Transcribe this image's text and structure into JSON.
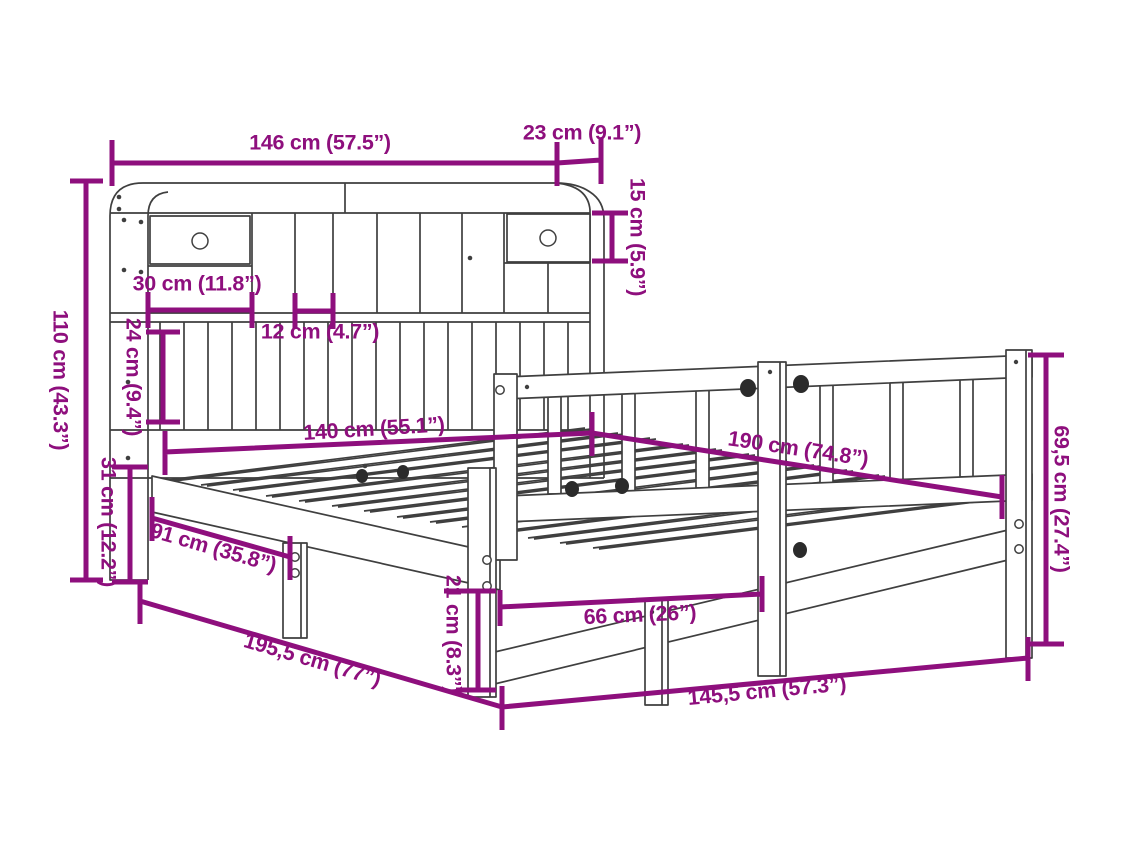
{
  "colors": {
    "accent": "#8E0F7D",
    "ink": "#3F3F3F",
    "background": "#FFFFFF"
  },
  "dims": {
    "headboard_width": "146 cm (57.5”)",
    "shelf_depth": "23 cm (9.1”)",
    "top_cubby_height": "15 cm (5.9”)",
    "drawer_width": "30 cm (11.8”)",
    "cubby_width": "12 cm (4.7”)",
    "panel_height": "24 cm (9.4”)",
    "headboard_height": "110 cm (43.3”)",
    "frame_side_height": "31 cm (12.2”)",
    "bed_width": "140 cm (55.1”)",
    "bed_length": "190 cm (74.8”)",
    "railing_height": "69,5 cm (27.4”)",
    "side_opening_width": "91 cm (35.8”)",
    "leg_height": "21 cm (8.3”)",
    "leg_spacing": "66 cm (26”)",
    "frame_length": "145,5 cm (57.3”)",
    "total_length": "195,5 cm (77”)"
  }
}
